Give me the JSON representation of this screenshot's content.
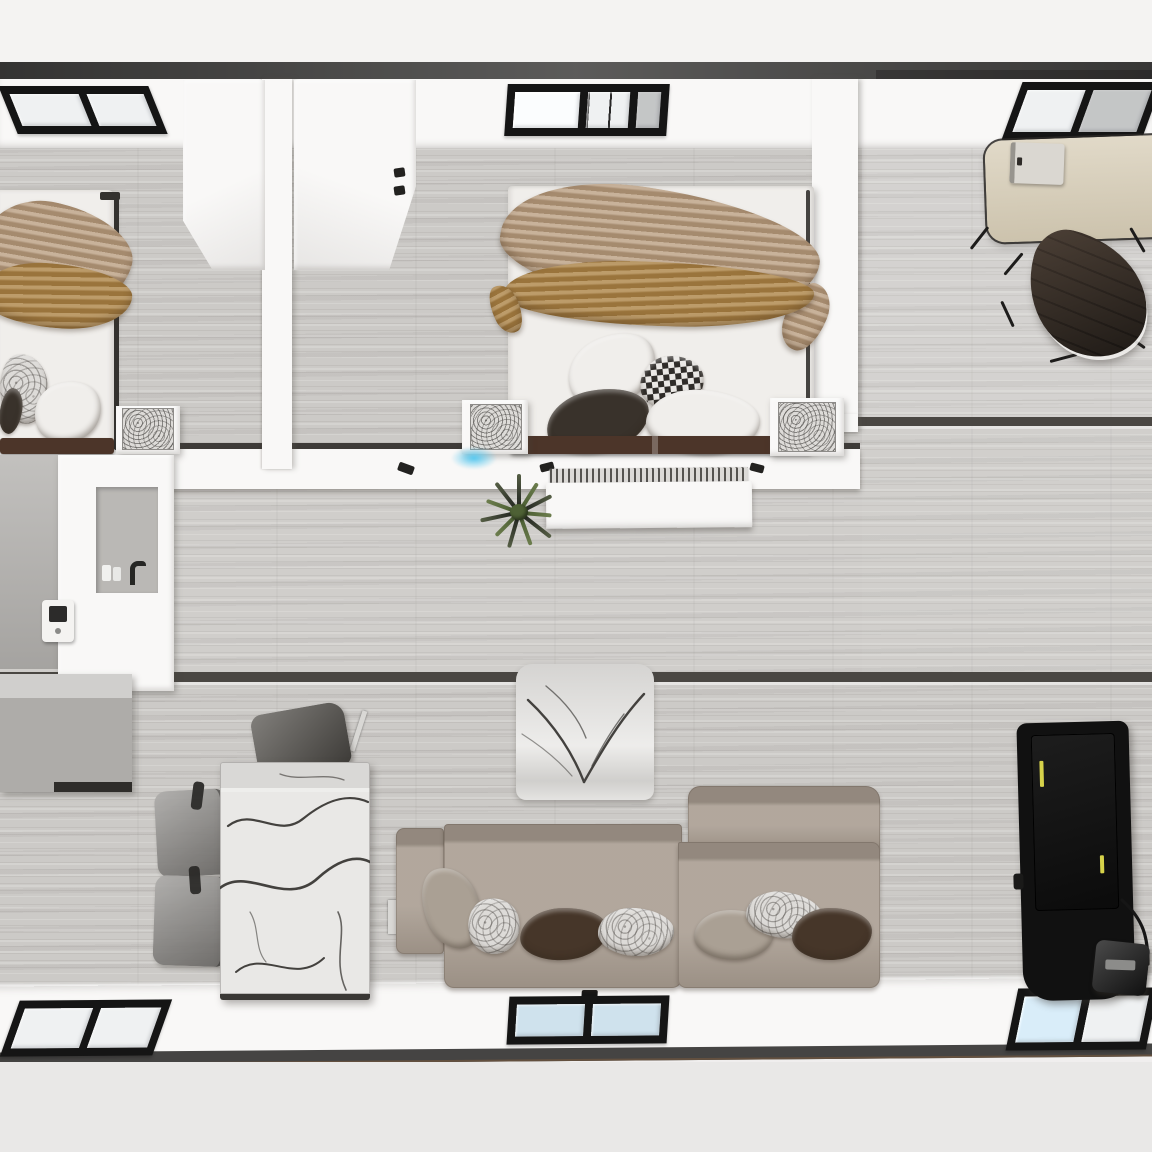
{
  "scene": {
    "title": "Top-down 3D render of a modular home floor plan",
    "rooms": {
      "bedroom_left": "Left bedroom",
      "bedroom_center": "Center bedroom",
      "office": "Home office nook",
      "bathroom": "Bathroom and kitchen block",
      "hallway": "Hallway",
      "living_dining": "Living and dining room"
    },
    "objects": {
      "bed": "Double bed with tan and ochre throws and pillows",
      "wardrobe": "White wardrobe cabinet",
      "wardrobe_handles": "Cabinet door handles",
      "nightstand": "Nightstand with marble decor box",
      "headboard": "Dark brown headboard",
      "desk": "Beige writing desk",
      "laptop": "Laptop on desk",
      "office_chair": "Dark brown swivel chair",
      "dining_table": "White marble dining table",
      "dining_chair_gray": "Gray upholstered dining chair",
      "dining_chair_smoke": "Smoked translucent dining chair",
      "accent_chair_marble": "Marble-patterned accent chair",
      "sofa": "Two-section taupe sofa with armrest",
      "pillow_set": "Throw pillows (taupe, marble, dark brown)",
      "tv": "Black wall TV with yellow status marks",
      "tv_bracket": "TV cable and floor bracket",
      "console": "Hallway console with vent grille",
      "plant": "Spiky potted plant",
      "vanity": "Bathroom vanity with faucet and bottles",
      "thermostat": "Wall thermostat",
      "kitchen_cabinet": "Gray base cabinet",
      "window": "Black-framed window",
      "roof_edge": "Dark roof edge strip",
      "status_glow": "Small blue light glow on hallway wall"
    },
    "counts": {
      "windows_top": 3,
      "windows_bottom": 3,
      "beds": 2,
      "sofa_sections": 2
    }
  },
  "palette": {
    "bg": "#f3f2f1",
    "ground": "#e9e8e7",
    "roof_edge": "#454443",
    "wall_white": "#f9f8f7",
    "floor_base": "#cccac7",
    "seam_dark": "#4a4743",
    "window_frame": "#151515",
    "window_glass": "#eff1f2",
    "window_glass_blue": "#cfe2ed",
    "bed_white": "#f0eeeb",
    "drape_tan": "#b89c7e",
    "drape_ochre": "#aa8040",
    "headboard_brown": "#4c3529",
    "pillow_dark": "#39322b",
    "desk_tan": "#d7cdb6",
    "chair_dark_brown": "#352d26",
    "chair_smoke": "#8e8c89",
    "chair_gray": "#57544f",
    "marble_light": "#e9e8e6",
    "sofa_taupe": "#a79b8f",
    "pillow_taupe": "#aaa094",
    "pillow_marble": "#dddbd8",
    "pillow_brown": "#463629",
    "counter_gray": "#b7b5b2",
    "bath_wall_gray": "#b3b1ae",
    "tv_black": "#111111",
    "tv_label_yellow": "#d6d24a",
    "plant_green": "#4e6135",
    "plant_dark": "#2f332a",
    "glow_blue": "#55c8f0"
  }
}
